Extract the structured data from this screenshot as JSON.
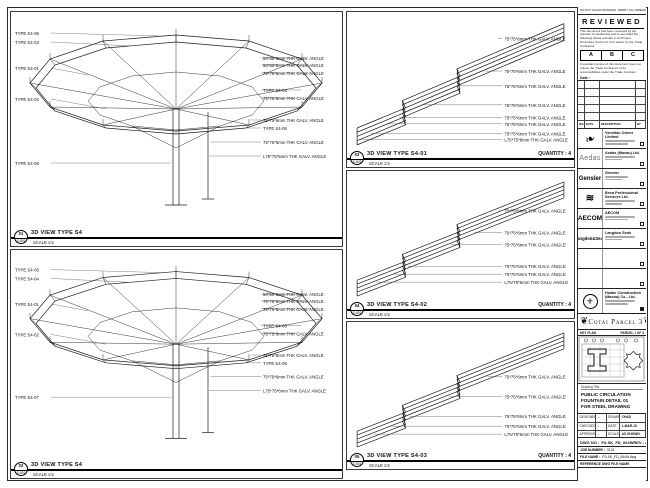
{
  "sheet": {
    "top_note": "DO NOT SCALE DRAWING. VERIFY ALL DIMENSIONS ON SITE."
  },
  "stamp": {
    "title": "REVIEWED",
    "body1": "This document has been reviewed by the relevant Consultant(s) and is accorded the following status relevant to its Project Procedure Section 6.4 for action by the Trade Contractor.",
    "options": [
      "A",
      "B",
      "C"
    ],
    "body2": "Consultant review of this document does not relieve the Trade Contractor of its responsibilities under the Trade Contract.",
    "date_label": "Date :"
  },
  "revision_table": {
    "headers": [
      "NO.",
      "DATE",
      "DESCRIPTION",
      "BY"
    ]
  },
  "consultants": [
    {
      "icon": "venetian-flourish-logo",
      "glyph": "❧",
      "name": "Venetian Orient Limited"
    },
    {
      "icon": "aedas-logo",
      "glyph": "Aedas",
      "name": "Aedas (Macau) Ltd."
    },
    {
      "icon": "gensler-logo",
      "glyph": "Gensler",
      "name": "Gensler"
    },
    {
      "icon": "beca-waves-logo",
      "glyph": "≋",
      "name": "Beca Professional Services Ltd."
    },
    {
      "icon": "aecom-logo",
      "glyph": "AECOM",
      "name": "AECOM"
    },
    {
      "icon": "langdon-seah-logo",
      "glyph": "Langdon&Seah",
      "name": "Langdon Seah"
    }
  ],
  "contractor": {
    "icon": "contractor-crest-logo",
    "glyph": "⚜",
    "name": "Hsabe Construction (Macau) Co., Ltd."
  },
  "project": {
    "banner": "Cotai Parcel 3",
    "ornament": "❦",
    "key_plan_label": "KEY PLAN",
    "key_plan_right": "PARCEL 1 OF 3"
  },
  "title_block": {
    "drawing_title_label": "Drawing Title",
    "drawing_title_lines": [
      "PUBLIC CIRCULATION",
      "FOUNTAIN DETAIL 01",
      "FOR STEEL DRAWING"
    ],
    "fields": {
      "designed_label": "DESIGNED",
      "designed": "-",
      "drawn_label": "DRAWN",
      "drawn": "CHAD",
      "checked_label": "CHECKED",
      "checked": "-",
      "date_label": "DATE",
      "date": "1-MAR-15",
      "approved_label": "APPROVED",
      "approved": "-",
      "scale_label": "SCALE",
      "scale": "AS SHOWN"
    },
    "dwg_no_label": "DWG NO :",
    "dwg_no": "P3-SK_FD_064W",
    "rev_label": "REV :",
    "rev": "A",
    "job_label": "JOB NUMBER :",
    "job": "3132",
    "file_label": "FILE NAME :",
    "file": "P3-SK_FD_064W.dwg",
    "ref_label": "REFERENCE DWG FILE NAME"
  },
  "views": {
    "left_top": {
      "bubble_no": "01",
      "bubble_sheet": "S-501",
      "title": "3D VIEW TYPE S4",
      "scale": "SCALE 1:5",
      "left_callouts": [
        "TYPE S4-05",
        "TYPE S4-03",
        "TYPE S4-01",
        "TYPE S4-02",
        "TYPE S4-08"
      ],
      "right_callouts": [
        "50*50*5mm THK GALV. ANGLE",
        "50*50*5mm THK GALV. ANGLE",
        "75*75*6mm THK GALV. ANGLE",
        "TYPE S4-04",
        "75*75*6mm THK GALV. ANGLE",
        "75*75*6mm THK GALV. ANGLE",
        "TYPE S4-06",
        "75*75*6mm THK GALV. ANGLE",
        "L75*75*6mm THK GALV. ANGLE"
      ]
    },
    "left_bottom": {
      "bubble_no": "02",
      "bubble_sheet": "S-501",
      "title": "3D VIEW TYPE S4",
      "scale": "SCALE 1:5",
      "left_callouts": [
        "TYPE S4-06",
        "TYPE S4-04",
        "TYPE S4-01",
        "TYPE S4-02",
        "TYPE S4-07"
      ],
      "right_callouts": [
        "50*50*5mm THK GALV. ANGLE",
        "75*75*6mm THK GALV. ANGLE",
        "75*75*6mm THK GALV. ANGLE",
        "TYPE S4-03",
        "75*75*6mm THK GALV. ANGLE",
        "75*75*6mm THK GALV. ANGLE",
        "TYPE S4-05",
        "75*75*6mm THK GALV. ANGLE",
        "L75*75*6mm THK GALV. ANGLE"
      ]
    },
    "mid": [
      {
        "bubble_no": "03",
        "bubble_sheet": "S-501",
        "title": "3D VIEW TYPE S4-01",
        "quantity": "QUANTITY : 4",
        "scale": "SCALE 1:5",
        "callouts": [
          "75*75*6mm THK GALV. ANGLE",
          "75*75*6mm THK GALV. ANGLE",
          "75*75*6mm THK GALV. ANGLE",
          "75*75*6mm THK GALV. ANGLE",
          "75*75*6mm THK GALV. ANGLE",
          "75*75*6mm THK GALV. ANGLE",
          "75*75*6mm THK GALV. ANGLE",
          "L75*75*6mm THK GALV. ANGLE"
        ]
      },
      {
        "bubble_no": "04",
        "bubble_sheet": "S-501",
        "title": "3D VIEW TYPE S4-02",
        "quantity": "QUANTITY : 4",
        "scale": "SCALE 1:5",
        "callouts": [
          "75*75*6mm THK GALV. ANGLE",
          "75*75*6mm THK GALV. ANGLE",
          "75*75*6mm THK GALV. ANGLE",
          "75*75*6mm THK GALV. ANGLE",
          "75*75*6mm THK GALV. ANGLE",
          "L75*75*6mm THK GALV. ANGLE"
        ]
      },
      {
        "bubble_no": "05",
        "bubble_sheet": "S-501",
        "title": "3D VIEW TYPE S4-03",
        "quantity": "QUANTITY : 4",
        "scale": "SCALE 1:5",
        "callouts": [
          "75*75*6mm THK GALV. ANGLE",
          "75*75*6mm THK GALV. ANGLE",
          "75*75*6mm THK GALV. ANGLE",
          "75*75*6mm THK GALV. ANGLE",
          "L75*75*6mm THK GALV. ANGLE"
        ]
      }
    ]
  }
}
